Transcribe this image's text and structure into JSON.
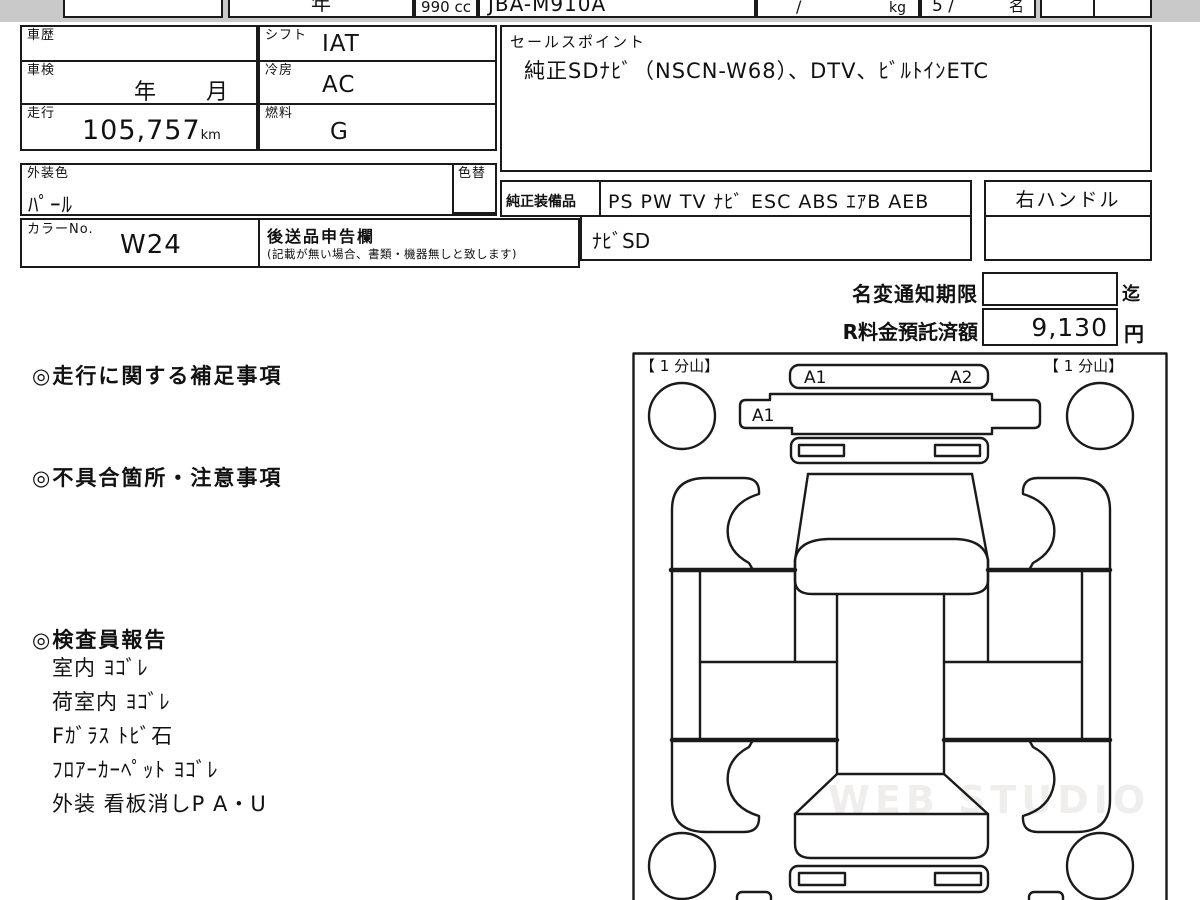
{
  "top_row": {
    "cell_year": "年",
    "cell_displacement": "990 cc",
    "cell_model_code": "JBA-M910A",
    "cell_weight_slash": "/",
    "cell_weight_unit": "kg",
    "cell_capacity": "5 /",
    "cell_capacity_unit": "名"
  },
  "vehicle_table": {
    "history_label": "車歴",
    "inspection_label": "車検",
    "inspection_value": "年　月",
    "mileage_label": "走行",
    "mileage_value": "105,757",
    "mileage_unit": "km",
    "shift_label": "シフト",
    "shift_value": "IAT",
    "aircon_label": "冷房",
    "aircon_value": "AC",
    "fuel_label": "燃料",
    "fuel_value": "G",
    "exterior_color_label": "外装色",
    "exterior_color_value": "ﾊﾟｰﾙ",
    "color_change_label": "色替",
    "color_no_label": "カラーNo.",
    "color_no_value": "W24",
    "later_goods_label": "後送品申告欄",
    "later_goods_note": "(記載が無い場合、書類・機器無しと致します)"
  },
  "sales_point": {
    "label": "セールスポイント",
    "text": "純正SDﾅﾋﾞ（NSCN-W68）、DTV、ﾋﾞﾙﾄｲﾝETC"
  },
  "equipment": {
    "label": "純正装備品",
    "values": "PS PW TV ﾅﾋﾞ ESC ABS ｴｱB AEB",
    "steering": "右ハンドル",
    "nav_type": "ﾅﾋﾞSD"
  },
  "fees": {
    "name_change_label": "名変通知期限",
    "name_change_suffix": "迄",
    "recycle_label": "R料金預託済額",
    "recycle_value": "9,130",
    "recycle_unit": "円"
  },
  "remarks": {
    "mileage_heading": "◎走行に関する補足事項",
    "defects_heading": "◎不具合箇所・注意事項",
    "inspector_heading": "◎検査員報告",
    "inspector_items": [
      "室内 ﾖｺﾞﾚ",
      "荷室内 ﾖｺﾞﾚ",
      "Fｶﾞﾗｽ ﾄﾋﾞ石",
      "ﾌﾛｱｰｶｰﾍﾟｯﾄ ﾖｺﾞﾚ",
      "外装 看板消しP A・U"
    ]
  },
  "diagram": {
    "tire_front_left_label": "【 1 分山】",
    "tire_front_right_label": "【 1 分山】",
    "mark_front_bumper_1": "A1",
    "mark_front_bumper_2": "A2",
    "mark_front_panel": "A1",
    "watermark": "WEB STUDIO PRO"
  },
  "colors": {
    "line": "#1a1a1a",
    "top_band": "#c9c9c9",
    "watermark": "#f0eded"
  }
}
